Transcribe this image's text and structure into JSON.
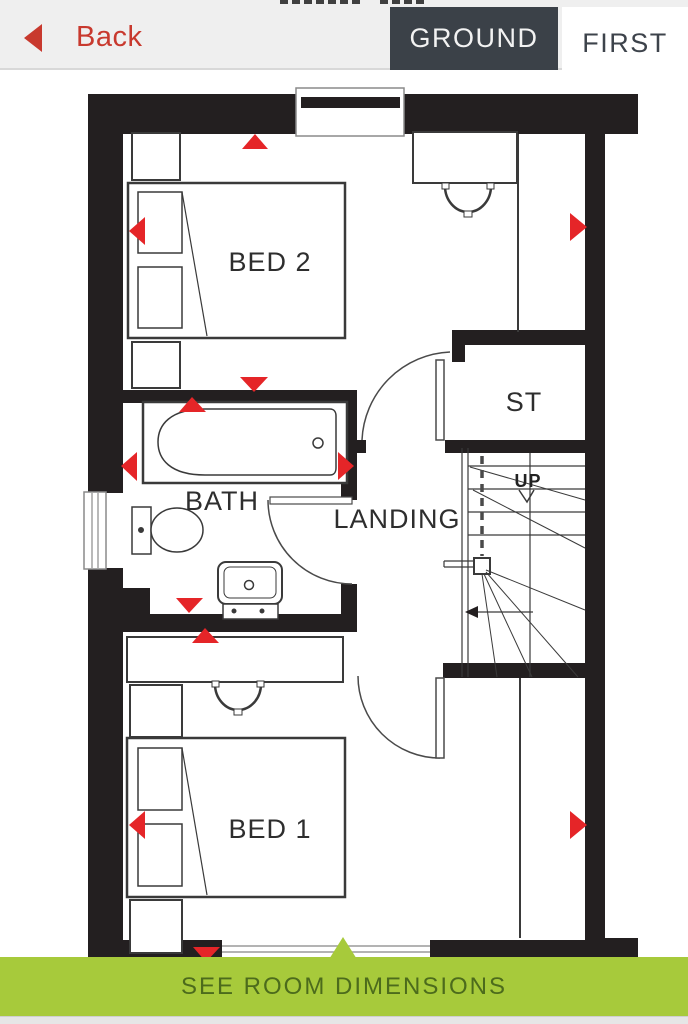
{
  "header": {
    "back_label": "Back",
    "tabs": [
      {
        "label": "GROUND",
        "active": true
      },
      {
        "label": "FIRST",
        "active": false
      }
    ],
    "active_tab": "GROUND"
  },
  "floorplan": {
    "floor_shown": "FIRST",
    "rooms": [
      {
        "id": "bed2",
        "label": "BED 2"
      },
      {
        "id": "bath",
        "label": "BATH"
      },
      {
        "id": "landing",
        "label": "LANDING"
      },
      {
        "id": "st",
        "label": "ST"
      },
      {
        "id": "bed1",
        "label": "BED 1"
      }
    ],
    "stairs_label": "UP"
  },
  "footer": {
    "label": "SEE ROOM DIMENSIONS"
  },
  "colors": {
    "accent_red": "#c8392e",
    "arrow_red": "#e52528",
    "wall_black": "#231f20",
    "tab_dark": "#3b4148",
    "header_gray": "#efefef",
    "footer_green": "#a7ca3b",
    "footer_text_green": "#4c6b1c"
  }
}
